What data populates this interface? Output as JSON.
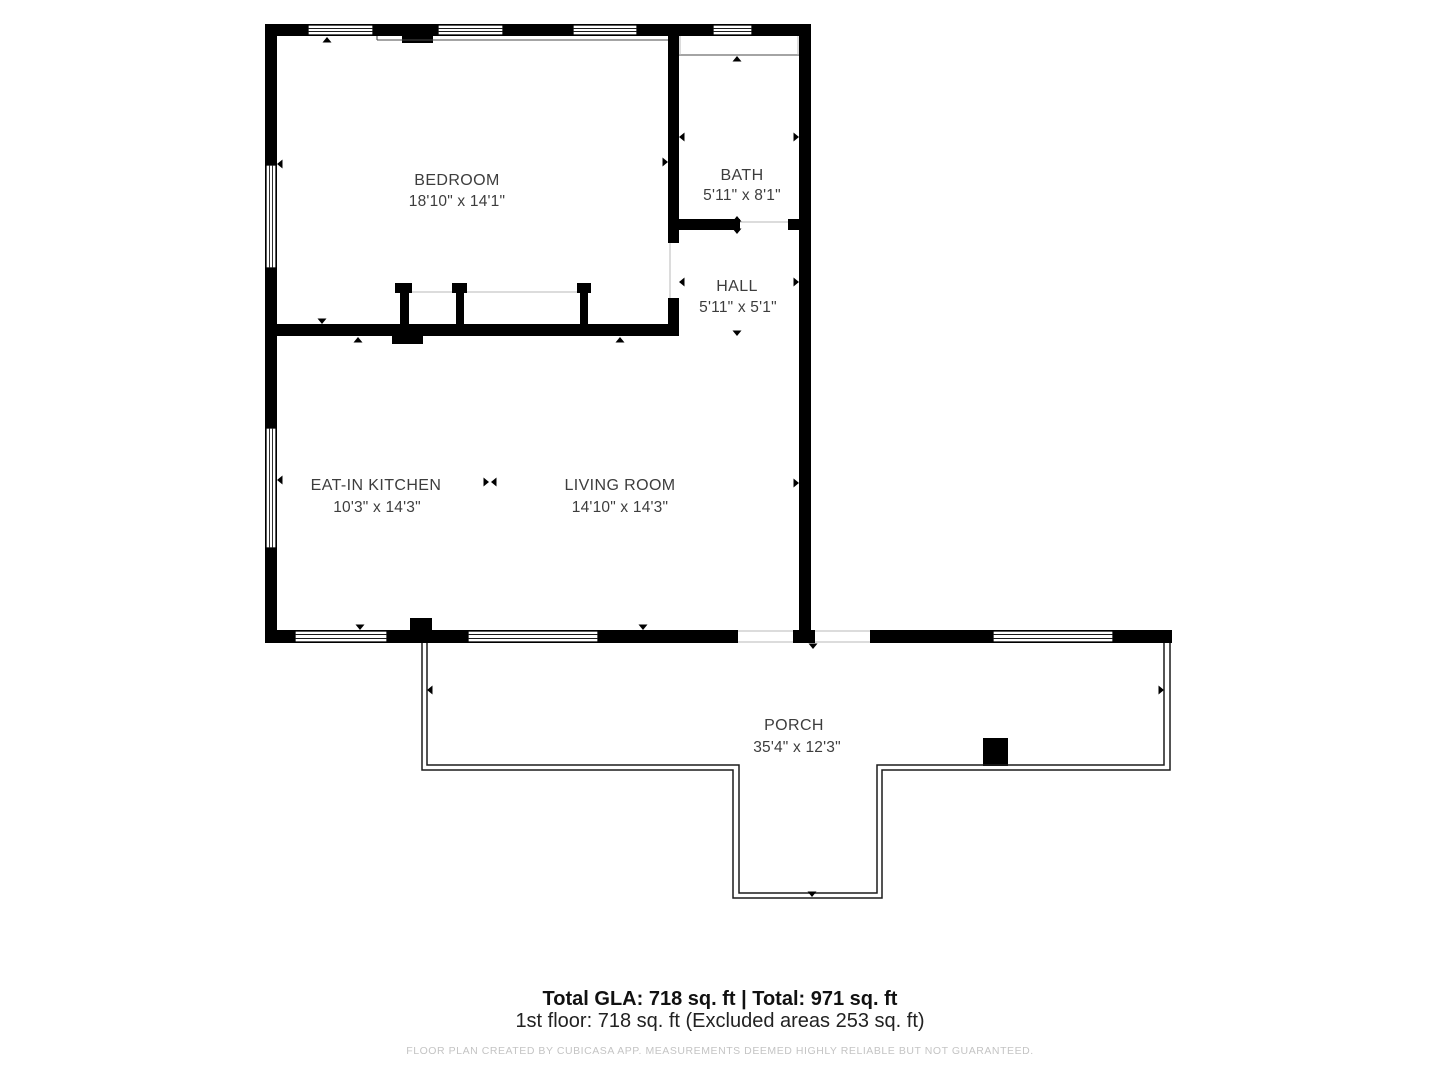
{
  "floor_plan": {
    "rooms": [
      {
        "id": "bedroom",
        "name": "BEDROOM",
        "dims": "18'10\" x 14'1\""
      },
      {
        "id": "bath",
        "name": "BATH",
        "dims": "5'11\" x 8'1\""
      },
      {
        "id": "hall",
        "name": "HALL",
        "dims": "5'11\" x 5'1\""
      },
      {
        "id": "kitchen",
        "name": "EAT-IN KITCHEN",
        "dims": "10'3\" x 14'3\""
      },
      {
        "id": "living",
        "name": "LIVING ROOM",
        "dims": "14'10\" x 14'3\""
      },
      {
        "id": "porch",
        "name": "PORCH",
        "dims": "35'4\" x 12'3\""
      }
    ],
    "footer": {
      "totals": "Total GLA: 718 sq. ft | Total: 971 sq. ft",
      "first_floor": "1st floor: 718 sq. ft (Excluded areas 253 sq. ft)",
      "disclaimer": "FLOOR PLAN CREATED BY CUBICASA APP. MEASUREMENTS DEEMED HIGHLY RELIABLE BUT NOT GUARANTEED."
    },
    "colors": {
      "wall": "#000000",
      "background": "#ffffff",
      "label_text": "#3d3d3d",
      "disclaimer_text": "#c4c4c4"
    }
  }
}
